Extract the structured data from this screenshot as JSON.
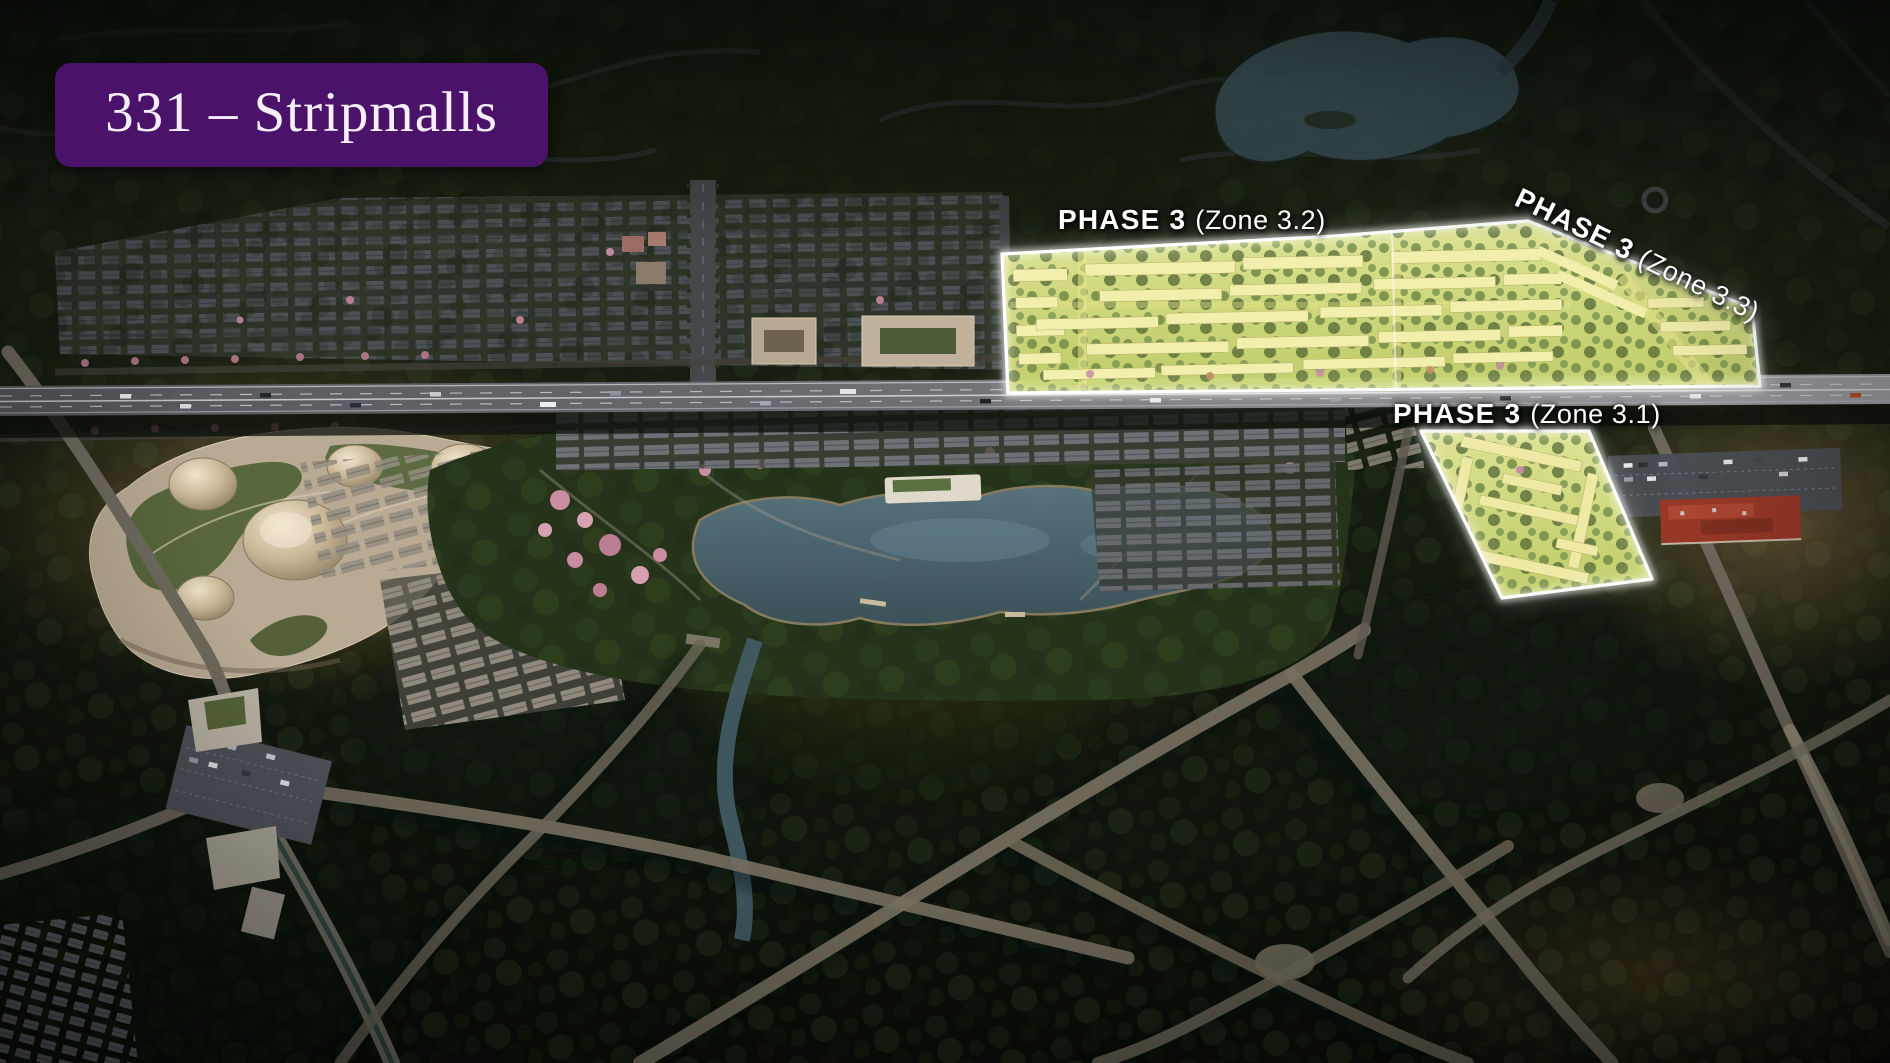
{
  "badge": {
    "title": "331 – Stripmalls"
  },
  "zone_labels": [
    {
      "phase": "PHASE 3",
      "zone": "(Zone 3.2)"
    },
    {
      "phase": "PHASE 3",
      "zone": "(Zone 3.3)"
    },
    {
      "phase": "PHASE 3",
      "zone": "(Zone 3.1)"
    }
  ],
  "colors": {
    "badge_background": "#4a1269",
    "badge_text": "#f6eefa",
    "zone_highlight_fill": "#dce584",
    "zone_highlight_border": "#ffffff",
    "label_text": "#ffffff"
  }
}
